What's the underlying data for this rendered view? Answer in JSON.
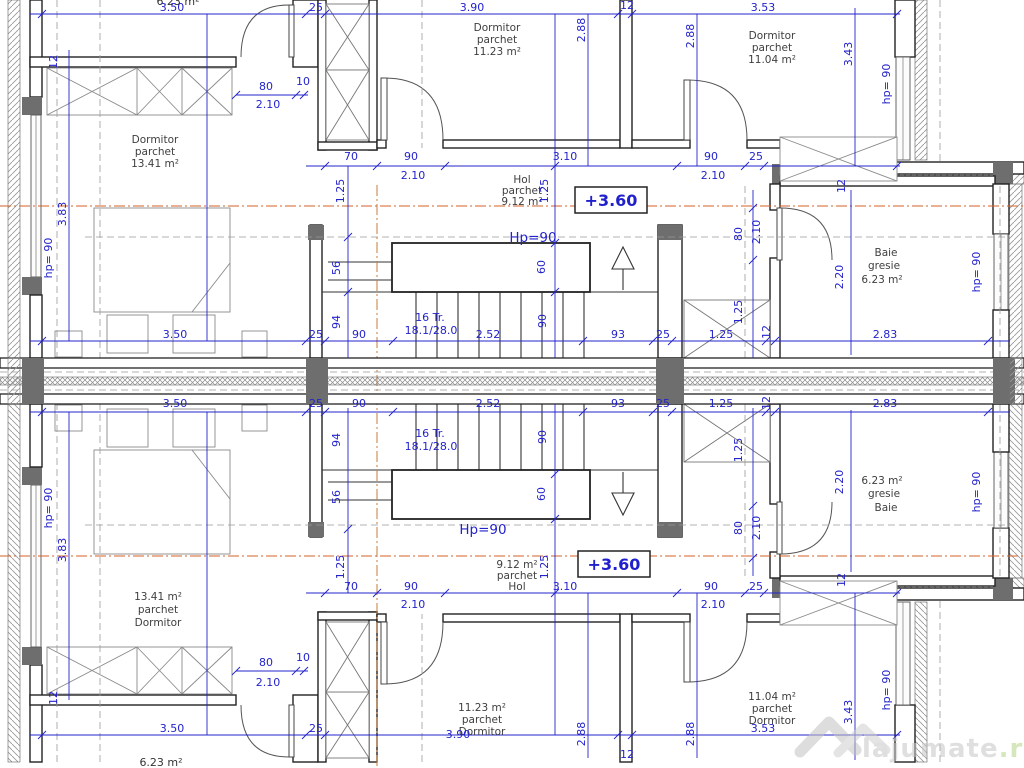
{
  "drawing": {
    "type": "architectural floor plan — duplex level, two mirrored apartments",
    "elevation_marker": "+3.60"
  },
  "rooms": {
    "dorm_left": {
      "name": "Dormitor",
      "finish": "parchet",
      "area": "13.41 m²"
    },
    "dorm_mid": {
      "name": "Dormitor",
      "finish": "parchet",
      "area": "11.23 m²"
    },
    "dorm_right": {
      "name": "Dormitor",
      "finish": "parchet",
      "area": "11.04 m²"
    },
    "hol": {
      "name": "Hol",
      "finish": "parchet",
      "area": "9.12 m²"
    },
    "baie": {
      "name": "Baie",
      "finish": "gresie",
      "area": "6.23 m²"
    }
  },
  "stair": {
    "treads": "16 Tr.",
    "riser": "18.1/28.0",
    "parapet": "Hp=90"
  },
  "labels": {
    "partial_top": "6.23 m²",
    "partial_bottom": "6.23 m²"
  },
  "dims": {
    "d350": "3.50",
    "d25": "25",
    "d390": "3.90",
    "d12": "12",
    "d353": "3.53",
    "d288": "2.88",
    "d343": "3.43",
    "d383": "3.83",
    "d80": "80",
    "d210": "2.10",
    "d10": "10",
    "d70": "70",
    "d90": "90",
    "d310": "3.10",
    "d125": "1.25",
    "d252": "2.52",
    "d93": "93",
    "d283": "2.83",
    "d220": "2.20",
    "d56": "56",
    "d60": "60",
    "d94": "94",
    "dhp": "hp= 90"
  },
  "watermark": {
    "brand": "lajumate",
    "tld": ".ro"
  }
}
